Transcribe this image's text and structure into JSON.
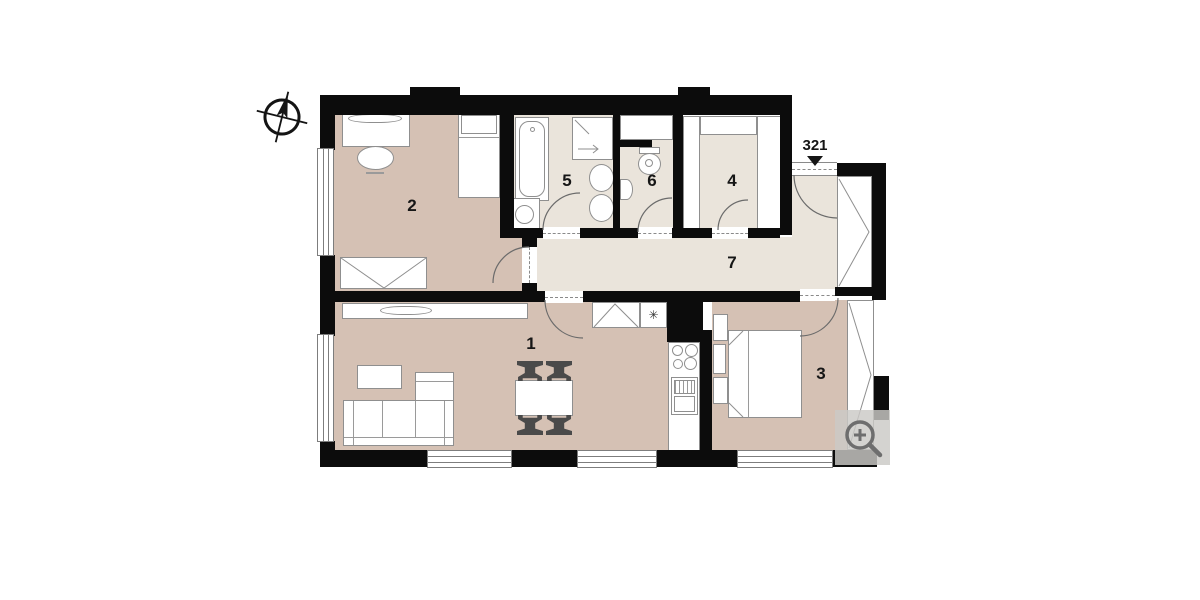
{
  "plan": {
    "unit_label": "321",
    "rooms": [
      {
        "number": "1",
        "role": "living-room-kitchen"
      },
      {
        "number": "2",
        "role": "bedroom"
      },
      {
        "number": "3",
        "role": "bedroom"
      },
      {
        "number": "4",
        "role": "walk-in-closet"
      },
      {
        "number": "5",
        "role": "bathroom"
      },
      {
        "number": "6",
        "role": "wc"
      },
      {
        "number": "7",
        "role": "hallway"
      }
    ],
    "symbols": {
      "fridge": "✳"
    }
  },
  "colors": {
    "wall": "#0c0c0c",
    "floor_living": "#d5c1b4",
    "floor_service": "#eae4db",
    "furniture_outline": "#8f8f8f",
    "magnifier_icon": "#6e6e6e",
    "magnifier_bg": "#cbc9c6"
  },
  "icons": {
    "compass": "compass-rose-icon",
    "entrance_marker": "entrance-arrow-icon",
    "zoom": "magnifier-plus-icon"
  }
}
